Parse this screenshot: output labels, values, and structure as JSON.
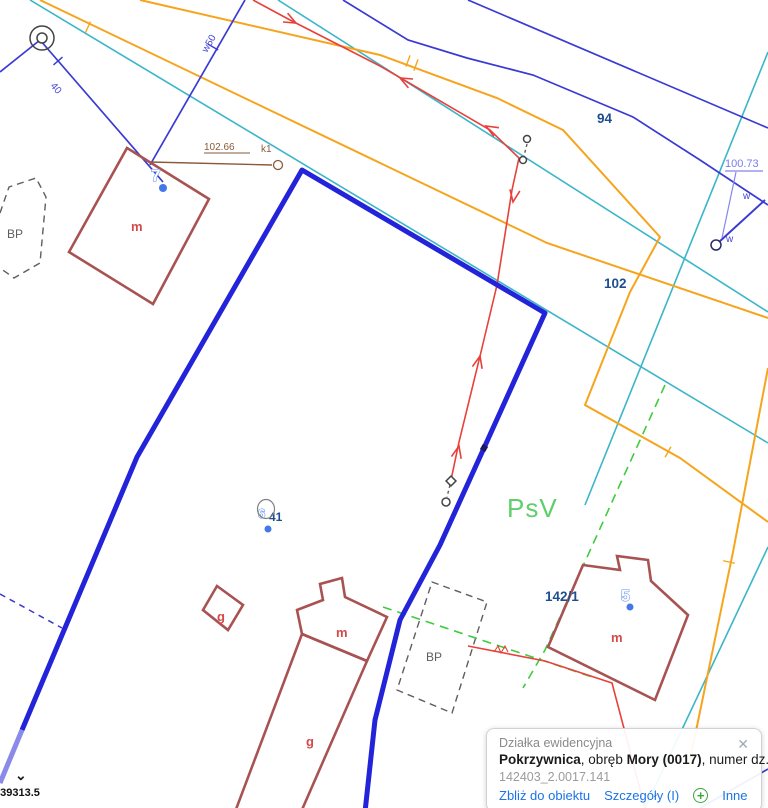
{
  "map": {
    "parcels": {
      "p94": "94",
      "p102": "102",
      "p142_1": "142/1",
      "p41": "41"
    },
    "addresses": {
      "a7": "7",
      "a5": "5",
      "a6": "6"
    },
    "buildings": {
      "m1": "m",
      "m2": "m",
      "g_small": "g",
      "g_long": "g",
      "m4": "m"
    },
    "land_use": {
      "bp_left": "BP",
      "bp_bottom": "BP",
      "psv": "PsV"
    },
    "annotations": {
      "dist1": "102.66",
      "k1": "k1",
      "dist2": "100.73",
      "w_upper": "w",
      "w_lower": "w",
      "pipe1": "40",
      "pipe2": "w50"
    }
  },
  "statusbar": {
    "coordinate": "639313.5",
    "collapse_icon": "⌄"
  },
  "popup": {
    "title": "Działka ewidencyjna",
    "close_icon": "✕",
    "subject": {
      "name": "Pokrzywnica",
      "sep1": ", obręb ",
      "district": "Mory (0017)",
      "sep2": ", numer dz.",
      "number": "141"
    },
    "identifier": "142403_2.0017.141",
    "actions": {
      "zoom_to": "Zbliż do obiektu",
      "details": "Szczegóły (I)",
      "add_icon": "+",
      "more": "Inne"
    }
  },
  "colors": {
    "selection_blue": "#2323d9",
    "parcel_cyan": "#3ab5c9",
    "boundary_navy": "#3a3ad4",
    "utility_orange": "#f7a41d",
    "utility_red": "#e8403a",
    "building_red": "#a85252",
    "green": "#3ecc3e",
    "label_navy": "#1d4e8f",
    "link_blue": "#1a73e8"
  }
}
